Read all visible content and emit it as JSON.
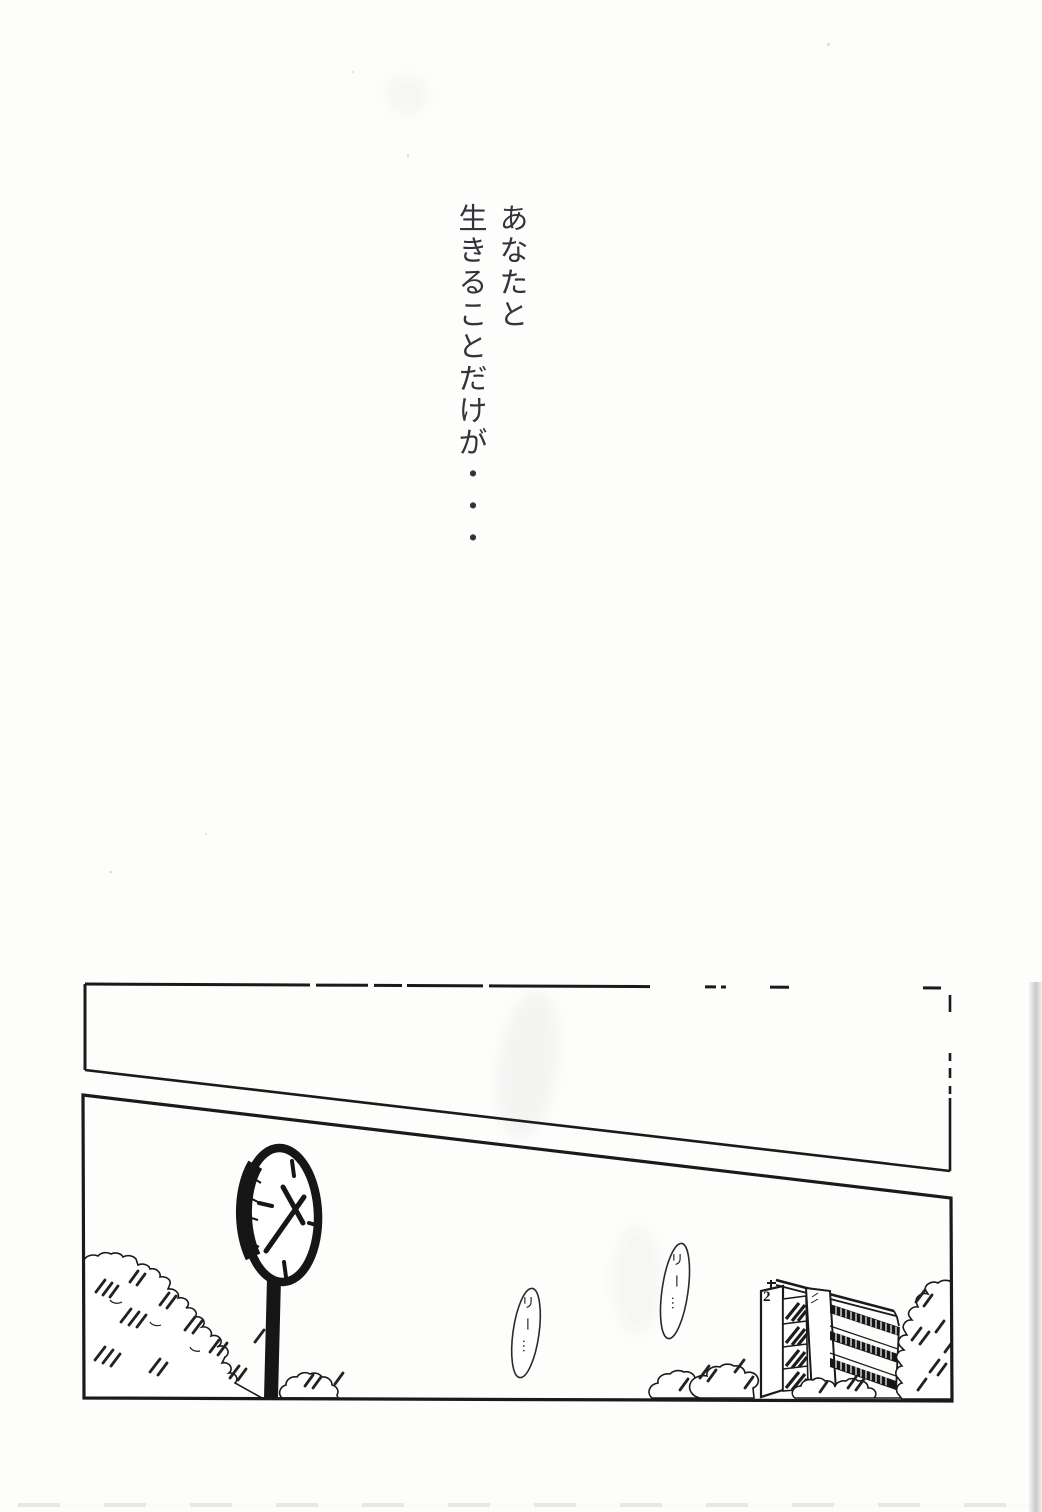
{
  "palette": {
    "paper": "#fdfdfc",
    "ink": "#1a1a1a",
    "caption_ink": "#33333b"
  },
  "caption": {
    "columns": [
      {
        "text": "あなたと"
      },
      {
        "text": "生きることだけが・・・"
      }
    ]
  },
  "sfx": [
    {
      "text": "リー…"
    },
    {
      "text": "リー…"
    }
  ],
  "building": {
    "sign": "2"
  }
}
